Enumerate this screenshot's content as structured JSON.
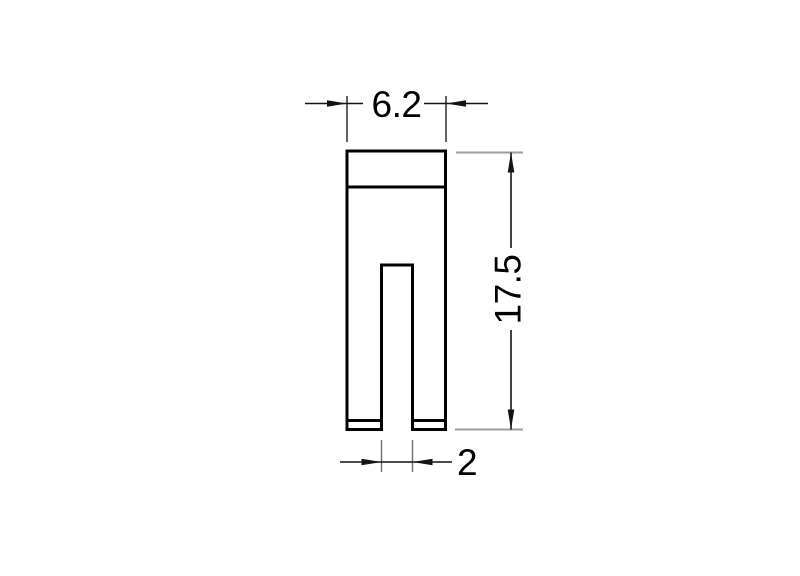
{
  "drawing": {
    "type": "technical dimension drawing",
    "part_name": "slotted fork-shaped component, front view",
    "dimensions": {
      "width_top": {
        "value": "6.2",
        "orientation": "horizontal",
        "position": "top"
      },
      "height_right": {
        "value": "17.5",
        "orientation": "vertical",
        "position": "right"
      },
      "slot_width_bottom": {
        "value": "2",
        "orientation": "horizontal",
        "position": "bottom"
      }
    },
    "colors": {
      "background": "#ffffff",
      "part_outline": "#000000",
      "dimension_lines": "#141414",
      "extension_lines_top": "#2e2e2e",
      "extension_lines_right": "#9e9e9e",
      "extension_lines_bottom": "#707070",
      "text": "#000000"
    }
  }
}
